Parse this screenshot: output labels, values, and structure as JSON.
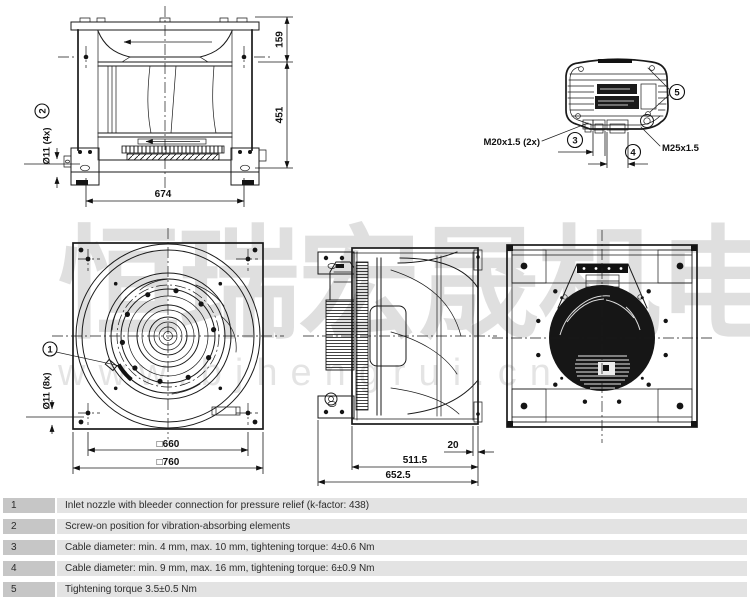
{
  "watermark": {
    "cjk": "恒瑞宏晟机电",
    "url": "www.bjhengrui.cn"
  },
  "callouts": {
    "c1": "1",
    "c2": "2",
    "c3": "3",
    "c4": "4",
    "c5": "5"
  },
  "views": {
    "front_elevation": {
      "dim_159": "159",
      "dim_451": "451",
      "dim_674": "674",
      "hole_label": "Ø11 (4x)"
    },
    "terminal_detail": {
      "gland_left": "M20x1.5 (2x)",
      "gland_right": "M25x1.5"
    },
    "front_view": {
      "dim_660": "□660",
      "dim_760": "□760",
      "hole_label": "Ø11 (8x)"
    },
    "side_view": {
      "dim_20": "20",
      "dim_511": "511.5",
      "dim_652": "652.5"
    }
  },
  "notes_table": {
    "rows": [
      {
        "num": "1",
        "text": "Inlet nozzle with bleeder connection for pressure relief (k-factor: 438)"
      },
      {
        "num": "2",
        "text": "Screw-on position for vibration-absorbing elements"
      },
      {
        "num": "3",
        "text": "Cable diameter: min. 4 mm, max. 10 mm, tightening torque: 4±0.6 Nm"
      },
      {
        "num": "4",
        "text": "Cable diameter: min. 9 mm, max. 16 mm, tightening torque: 6±0.9 Nm"
      },
      {
        "num": "5",
        "text": "Tightening torque 3.5±0.5 Nm"
      }
    ]
  },
  "colors": {
    "line": "#1a1a1a",
    "table_number_bg": "#c6c6c6",
    "table_row_bg": "#e3e3e3",
    "watermark": "#d9d9d9"
  }
}
